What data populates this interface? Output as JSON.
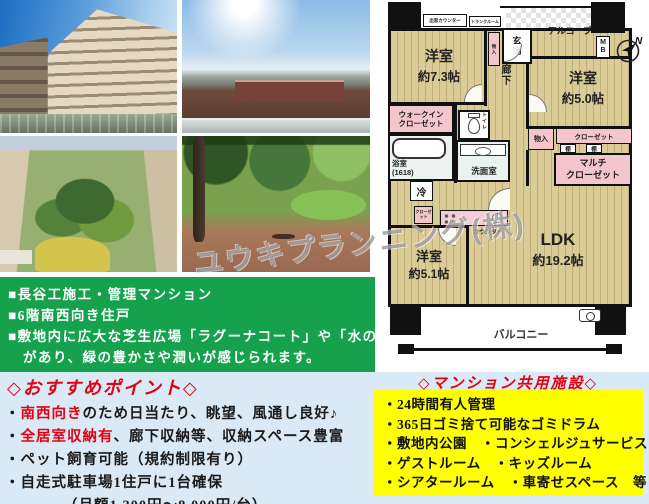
{
  "watermark": "ユウキプランニング(株)",
  "notes": {
    "line1": "■長谷工施工・管理マンション",
    "line2": "■6階南西向き住戸",
    "line3": "■敷地内に広大な芝生広場「ラグーナコート」や「水のテラス」",
    "line4": "　があり、緑の豊かさや潤いが感じられます。"
  },
  "recommend": {
    "title": "◇おすすめポイント◇",
    "items": [
      {
        "bullet": "・",
        "highlight": "南西向き",
        "rest": "のため日当たり、眺望、風通し良好♪"
      },
      {
        "bullet": "・",
        "highlight": "全居室収納有",
        "rest": "、廊下収納等、収納スペース豊富"
      },
      {
        "bullet": "・",
        "highlight": "",
        "rest": "ペット飼育可能（規約制限有り）"
      },
      {
        "bullet": "・",
        "highlight": "",
        "rest": "自走式駐車場1住戸に1台確保"
      },
      {
        "bullet": "",
        "highlight": "",
        "rest": "（月額1,200円～8,000円/台）"
      }
    ]
  },
  "facilities": {
    "title": "◇マンション共用施設◇",
    "items": [
      "・24時間有人管理",
      "・365日ゴミ捨て可能なゴミドラム",
      "・敷地内公園　・コンシェルジュサービス",
      "・ゲストルーム　・キッズルーム",
      "・シアタールーム　・車寄せスペース　等"
    ]
  },
  "floorplan": {
    "room73_name": "洋室",
    "room73_size": "約7.3帖",
    "room50_name": "洋室",
    "room50_size": "約5.0帖",
    "room51_name": "洋室",
    "room51_size": "約5.1帖",
    "ldk_name": "LDK",
    "ldk_size": "約19.2帖",
    "genkan": "玄関",
    "alcove": "アルコーブ",
    "corridor": "廊下",
    "wic": "ウォークイン\nクローゼット",
    "bath": "浴室\n(1618)",
    "washroom": "洗面室",
    "toilet": "トイレ",
    "fridge": "冷",
    "counter": "カウンター",
    "bay_counter": "出窓カウンター",
    "trunk": "トランクルーム",
    "storage_entrance": "物入",
    "storage_right": "物入",
    "closet50": "クローゼット",
    "closet51": "クローゼット",
    "shelf1": "棚",
    "shelf2": "棚",
    "multi_closet": "マルチ\nクローゼット",
    "mb": "MB",
    "north": "N",
    "balcony": "バルコニー"
  }
}
